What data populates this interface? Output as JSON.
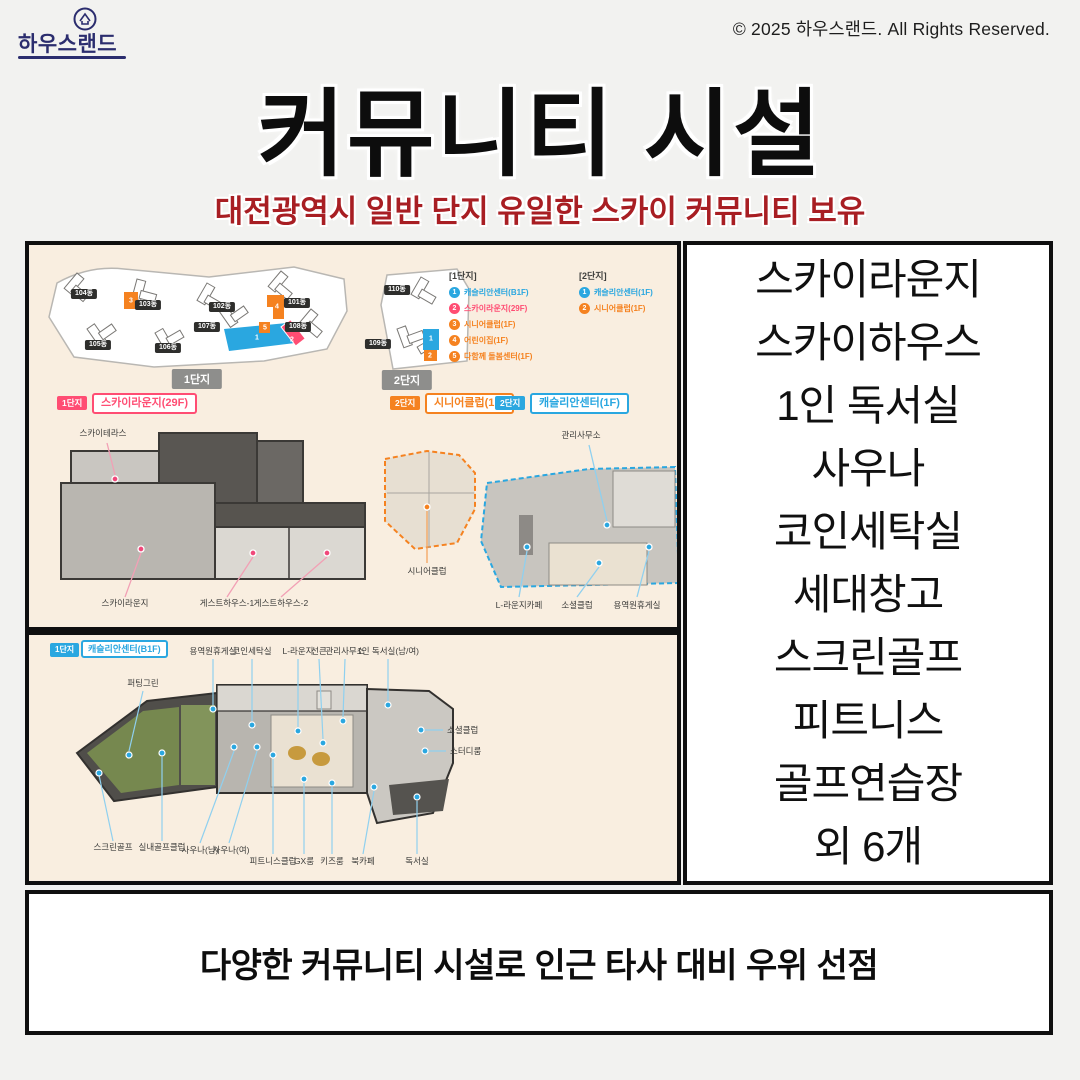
{
  "meta": {
    "brand": "하우스랜드",
    "copyright": "© 2025 하우스랜드. All Rights Reserved."
  },
  "header": {
    "title": "커뮤니티 시설",
    "subtitle": "대전광역시 일반 단지 유일한 스카이 커뮤니티 보유"
  },
  "site_plan": {
    "complex1": {
      "label": "1단지",
      "buildings": [
        "104동",
        "103동",
        "102동",
        "101동",
        "105동",
        "106동",
        "107동",
        "108동"
      ]
    },
    "complex2": {
      "label": "2단지",
      "buildings": [
        "110동",
        "109동"
      ]
    },
    "legend1": {
      "title": "[1단지]",
      "items": [
        {
          "num": "1",
          "label": "캐슬리안센터(B1F)"
        },
        {
          "num": "2",
          "label": "스카이라운지(29F)"
        },
        {
          "num": "3",
          "label": "시니어클럽(1F)"
        },
        {
          "num": "4",
          "label": "어린이집(1F)"
        },
        {
          "num": "5",
          "label": "다함께 돌봄센터(1F)"
        }
      ]
    },
    "legend2": {
      "title": "[2단지]",
      "items": [
        {
          "num": "1",
          "label": "캐슬리안센터(1F)"
        },
        {
          "num": "2",
          "label": "시니어클럽(1F)"
        }
      ]
    }
  },
  "plans": {
    "sky": {
      "badge": "1단지",
      "title": "스카이라운지(29F)",
      "labels": {
        "terrace": "스카이테라스",
        "lounge": "스카이라운지",
        "guest1": "게스트하우스-1",
        "guest2": "게스트하우스-2"
      }
    },
    "senior": {
      "badge": "2단지",
      "title": "시니어클럽(1F)",
      "labels": {
        "club": "시니어클럽"
      }
    },
    "cast1f": {
      "badge": "2단지",
      "title": "캐슬리안센터(1F)",
      "labels": {
        "office": "관리사무소",
        "cafe": "L-라운지카페",
        "social": "소셜클럽",
        "rest": "용역원휴게실"
      }
    },
    "b1f": {
      "badge": "1단지",
      "title": "캐슬리안센터(B1F)",
      "top": [
        "용역원휴게실",
        "코인세탁실",
        "L-라운지",
        "선큰",
        "관리사무소",
        "1인 독서실(남/여)"
      ],
      "left": [
        "퍼팅그린"
      ],
      "right": [
        "소셜클럽",
        "스터디룸"
      ],
      "bottom": [
        "스크린골프",
        "실내골프클럽",
        "사우나(남)",
        "사우나(여)",
        "피트니스클럽",
        "GX룸",
        "키즈룸",
        "북카페",
        "독서실"
      ]
    }
  },
  "facility_list": {
    "items": [
      "스카이라운지",
      "스카이하우스",
      "1인 독서실",
      "사우나",
      "코인세탁실",
      "세대창고",
      "스크린골프",
      "피트니스",
      "골프연습장",
      "외 6개"
    ]
  },
  "footer": {
    "text": "다양한 커뮤니티 시설로 인근 타사 대비 우위 선점"
  },
  "colors": {
    "bg": "#f2f2f0",
    "ink": "#111111",
    "cream": "#f9eee0",
    "pink": "#ff4d73",
    "orange": "#f58220",
    "blue": "#2aa7e0",
    "red": "#a81e23",
    "navy": "#2b2d6e",
    "line-pink": "#f2a0b5",
    "line-orange": "#f5a55e",
    "line-blue": "#8fd0ef"
  }
}
